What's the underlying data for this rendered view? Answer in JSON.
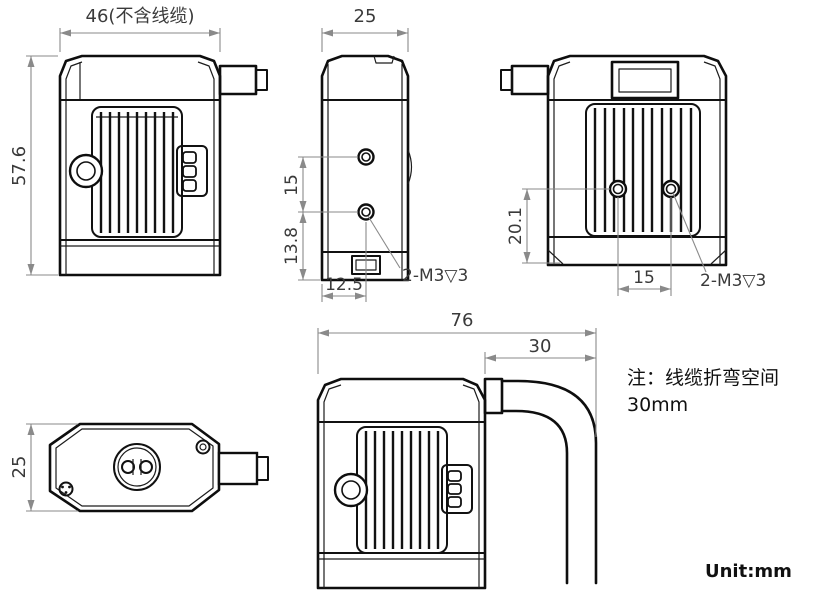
{
  "unit_label": "Unit:mm",
  "note": {
    "line1": "注：线缆折弯空间",
    "line2": "30mm"
  },
  "dims": {
    "body_width_no_cable": "46(不含线缆)",
    "body_height": "57.6",
    "body_depth": "25",
    "front_hole_spacing": "15",
    "front_hole_to_bottom": "13.8",
    "front_hole_offset": "12.5",
    "front_thread_spec": "2-M3▽3",
    "back_hole_to_bottom": "20.1",
    "back_hole_spacing": "15",
    "back_thread_spec": "2-M3▽3",
    "overall_width_with_cable": "76",
    "cable_bend_space": "30",
    "top_view_depth": "25"
  }
}
